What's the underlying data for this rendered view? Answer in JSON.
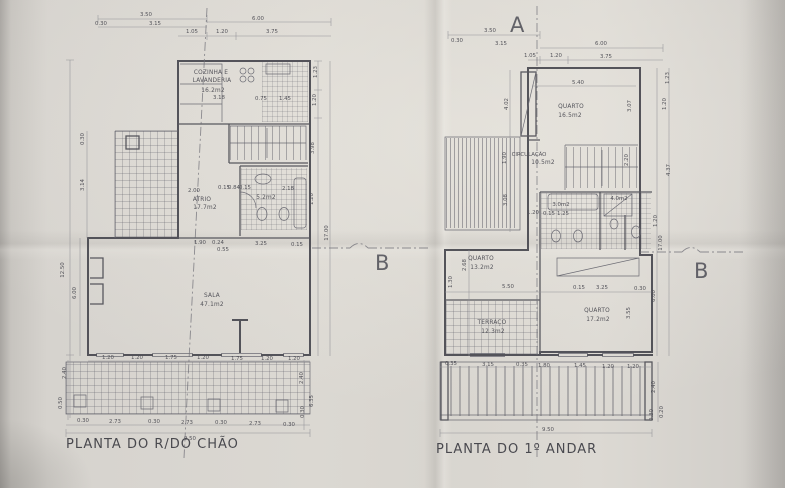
{
  "document": {
    "type_note": "architectural floor plan sheet, photographed",
    "markers": {
      "section_a": "A",
      "section_b": "B"
    }
  },
  "left_plan": {
    "caption": "PLANTA DO R/DO CHÃO",
    "rooms": {
      "kitchen": {
        "name_line1": "COZINHA E",
        "name_line2": "LAVANDERIA",
        "area": "16.2m2"
      },
      "atrio": {
        "name": "ATRIO",
        "area": "17.7m2"
      },
      "bath": {
        "area": "5.2m2"
      },
      "sala": {
        "name": "SALA",
        "area": "47.1m2"
      }
    },
    "dims": {
      "top": [
        "3.50",
        "0.30",
        "3.15",
        "6.00",
        "1.05",
        "1.20",
        "3.75"
      ],
      "kitchen_row": [
        "3.18",
        "0.75",
        "1.45"
      ],
      "atrio_row": [
        "2.00",
        "0.15",
        "0.84",
        "0.15",
        "2.18"
      ],
      "sala_top": [
        "1.90",
        "0.24",
        "3.25",
        "0.55",
        "0.15"
      ],
      "left_side": [
        "12.50",
        "6.00",
        "3.14",
        "0.30"
      ],
      "right_side": [
        "1.23",
        "1.20",
        "3.98",
        "1.20",
        "17.00"
      ],
      "windows": [
        "1.20",
        "1.20",
        "1.75",
        "1.20",
        "1.75",
        "1.20",
        "1.20"
      ],
      "columns": [
        "0.30",
        "2.73",
        "0.30",
        "2.73",
        "0.30",
        "2.73",
        "0.30"
      ],
      "total": "9.50",
      "right_lower": [
        "2.40",
        "6.35",
        "0.30"
      ],
      "left_lower": [
        "2.40",
        "0.50"
      ]
    }
  },
  "right_plan": {
    "caption": "PLANTA DO 1º ANDAR",
    "rooms": {
      "quarto1": {
        "name": "QUARTO",
        "area": "16.5m2"
      },
      "circulacao": {
        "name": "CIRCULAÇÃO",
        "area": "10.5m2"
      },
      "is_small": {
        "area": "3.0m2"
      },
      "is_suite": {
        "area": "4.0m2"
      },
      "quarto2": {
        "name": "QUARTO",
        "area": "13.2m2"
      },
      "terraco": {
        "name": "TERRAÇO",
        "area": "12.3m2"
      },
      "quarto3": {
        "name": "QUARTO",
        "area": "17.2m2"
      }
    },
    "dims": {
      "top": [
        "3.50",
        "0.30",
        "3.15",
        "6.00",
        "1.05",
        "1.20",
        "3.75"
      ],
      "quarto1_row": "5.40",
      "right_upper": [
        "1.23",
        "1.20",
        "3.07",
        "2.20"
      ],
      "bath_row": [
        "1.20",
        "0.15",
        "1.25"
      ],
      "mid_row": [
        "5.50",
        "0.15",
        "3.25",
        "0.30"
      ],
      "left_side": [
        "4.02",
        "1.90",
        "3.08",
        "2.68",
        "1.30"
      ],
      "right_side": [
        "4.37",
        "1.20",
        "17.00",
        "6.00",
        "3.55"
      ],
      "bottom": [
        "0.35",
        "3.15",
        "0.35",
        "1.80",
        "1.45",
        "1.20",
        "1.20"
      ],
      "total": "9.50",
      "right_lower": [
        "2.40",
        "0.20",
        "0.30"
      ]
    }
  }
}
